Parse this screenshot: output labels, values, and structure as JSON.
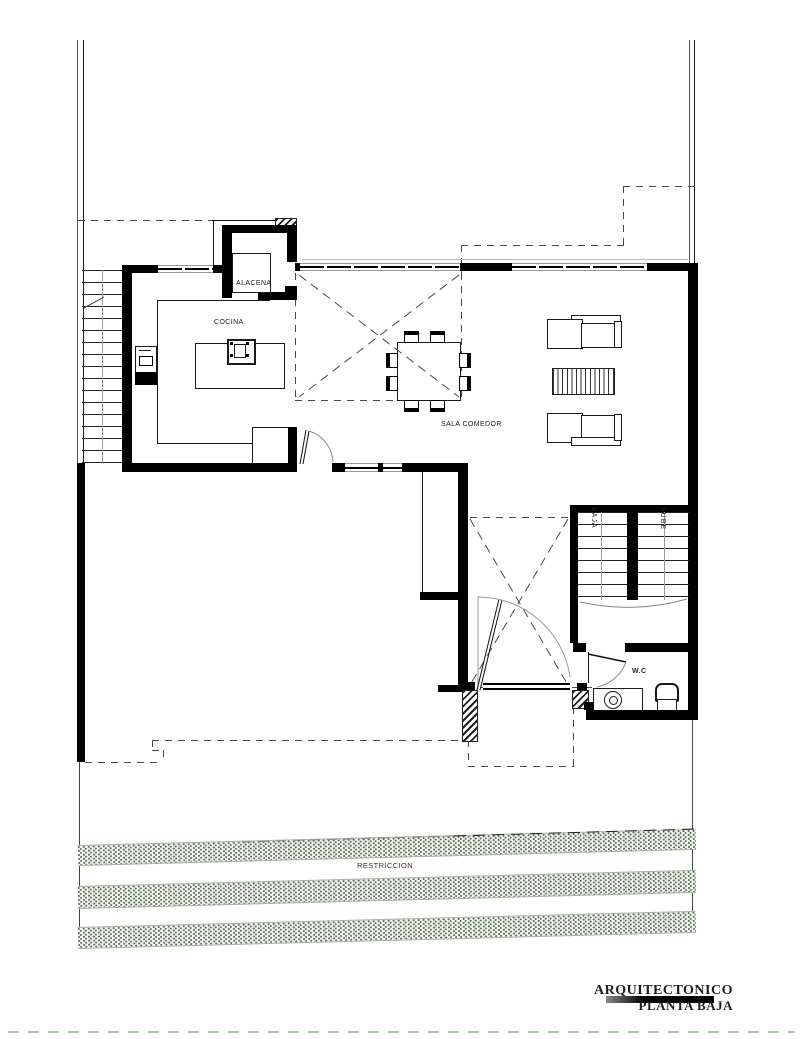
{
  "drawing": {
    "labels": {
      "alacena": "ALACENA",
      "cocina": "COCINA",
      "sala_comedor": "SALA COMEDOR",
      "baja": "BAJA",
      "sube": "SUBE",
      "wc": "W.C",
      "restriccion": "RESTRICCION"
    },
    "title_block": {
      "line1": "ARQUITECTONICO",
      "line2": "PLANTA BAJA"
    },
    "colors": {
      "wall": "#000000",
      "thin_line": "#1a1a1a",
      "dashed_projection": "#4a4a4a",
      "band_fill": "#f3f6f0",
      "band_dots": "#51664f",
      "band_edges": "#a3b5a0",
      "site_boundary_dash": "#a9c9a9",
      "text": "#222222"
    }
  }
}
